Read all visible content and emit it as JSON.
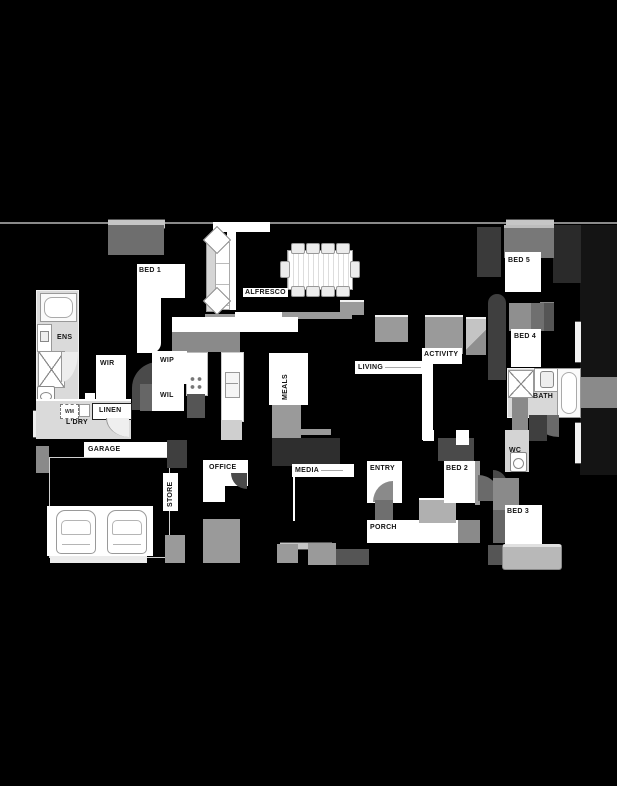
{
  "plan": {
    "type": "residential floor plan",
    "colors": {
      "background": "#000000",
      "room_floor_light": "#d9d9d9",
      "room_patch_white": "#ffffff",
      "wall_window_gray": "#9a9a9a",
      "furniture_dark_gray": "#4a4a4a",
      "label_text": "#141414"
    },
    "rooms": {
      "bed1": {
        "label": "BED 1"
      },
      "alfresco": {
        "label": "ALFRESCO"
      },
      "ens": {
        "label": "ENS"
      },
      "wir": {
        "label": "WIR"
      },
      "wip": {
        "label": "WIP"
      },
      "wil": {
        "label": "WIL"
      },
      "linen": {
        "label": "LINEN"
      },
      "ldry": {
        "label": "L'DRY"
      },
      "garage": {
        "label": "GARAGE"
      },
      "store": {
        "label": "STORE"
      },
      "office": {
        "label": "OFFICE"
      },
      "meals": {
        "label": "MEALS"
      },
      "living": {
        "label": "LIVING"
      },
      "activity": {
        "label": "ACTIVITY"
      },
      "bed5": {
        "label": "BED 5"
      },
      "bed4": {
        "label": "BED 4"
      },
      "bath": {
        "label": "BATH"
      },
      "wc": {
        "label": "WC"
      },
      "media": {
        "label": "MEDIA"
      },
      "entry": {
        "label": "ENTRY"
      },
      "bed2": {
        "label": "BED 2"
      },
      "bed3": {
        "label": "BED 3"
      },
      "porch": {
        "label": "PORCH"
      }
    },
    "appliances": {
      "washing_machine": {
        "label": "WM"
      }
    }
  }
}
